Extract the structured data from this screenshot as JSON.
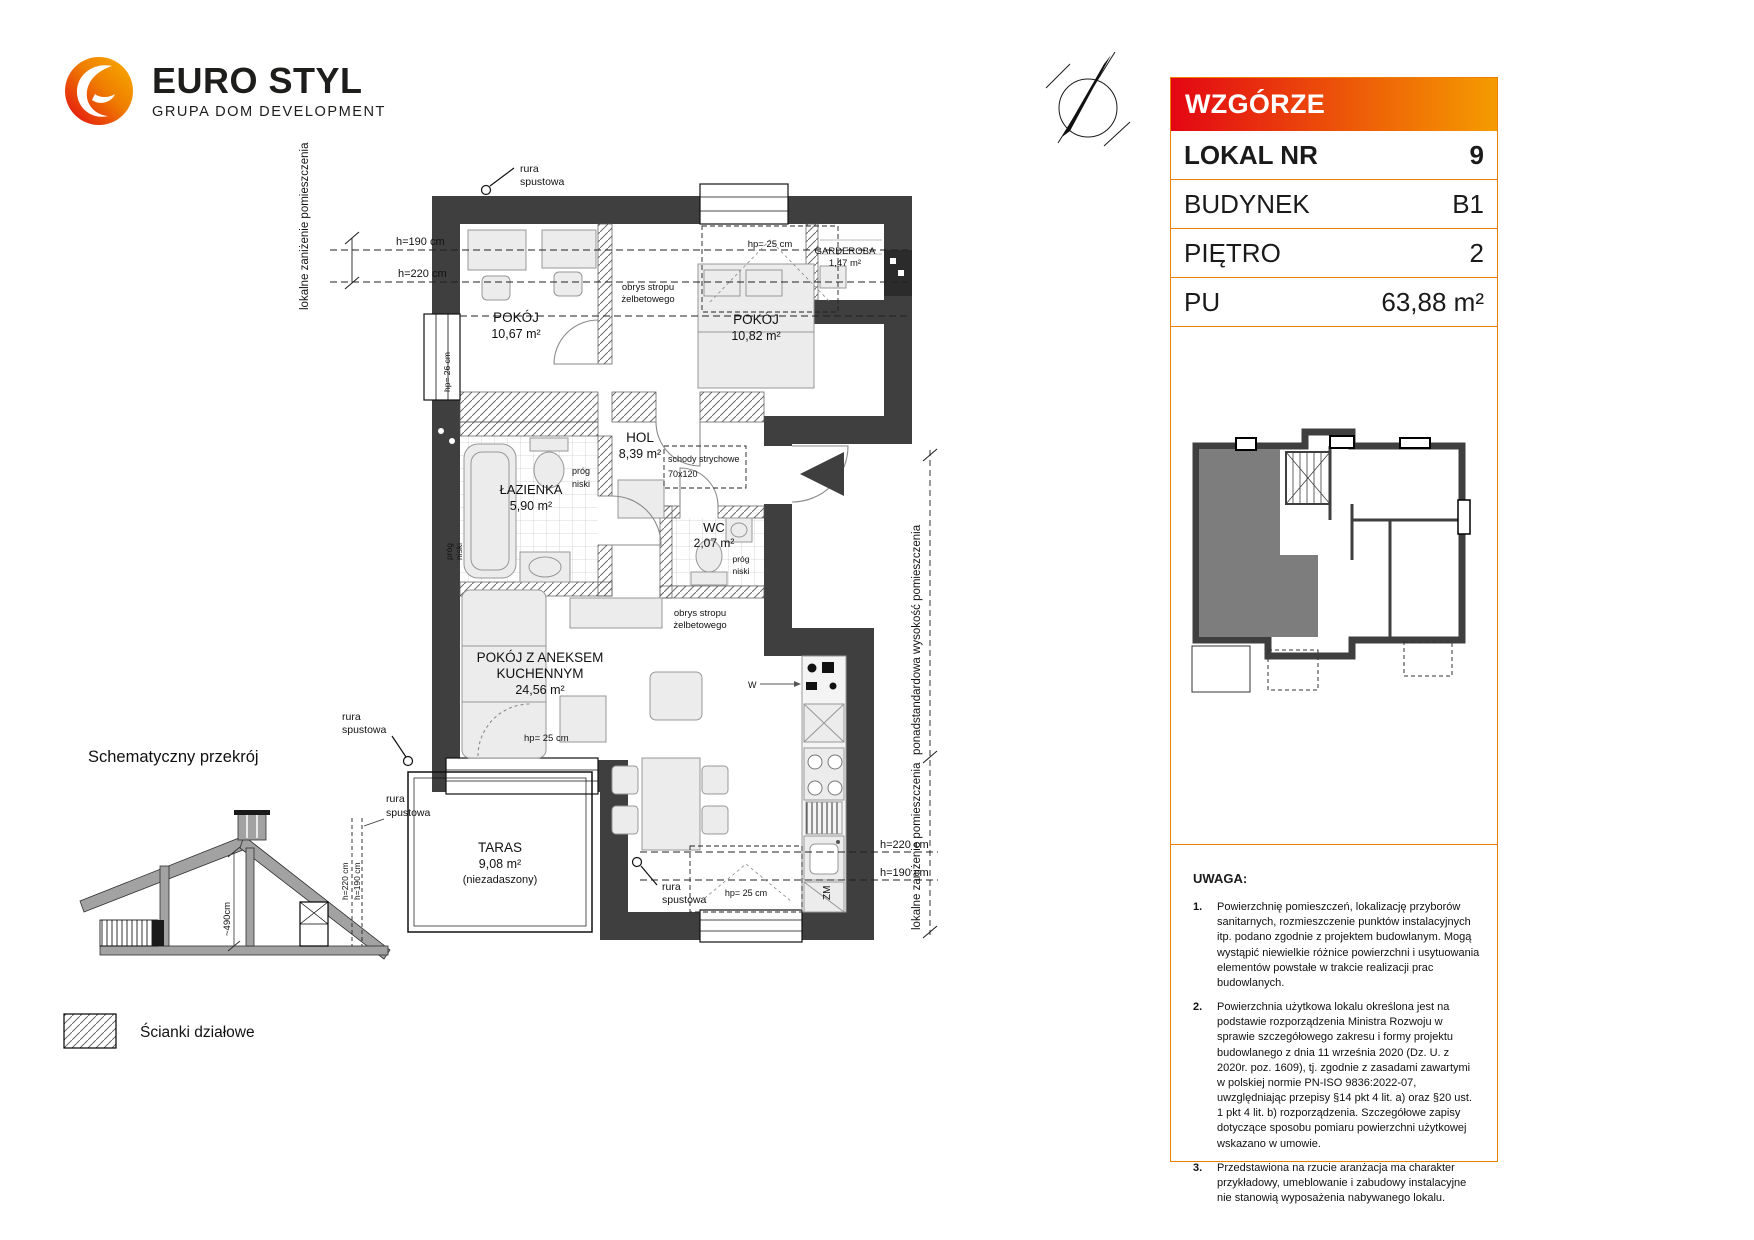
{
  "logo": {
    "brand": "EURO STYL",
    "tagline": "GRUPA DOM DEVELOPMENT"
  },
  "colors": {
    "accent_orange": "#ee7f00",
    "header_gradient_left": "#e30613",
    "header_gradient_right": "#f59c00",
    "wall": "#3f3f3f",
    "unit_highlight": "#7d7d7d"
  },
  "panel": {
    "title": "WZGÓRZE MARKOWCA",
    "rows": [
      {
        "label": "LOKAL NR",
        "value": "9"
      },
      {
        "label": "BUDYNEK",
        "value": "B1"
      },
      {
        "label": "PIĘTRO",
        "value": "2"
      },
      {
        "label": "PU",
        "value": "63,88 m²"
      }
    ],
    "notes_title": "UWAGA:",
    "notes": [
      {
        "num": "1.",
        "text": "Powierzchnię pomieszczeń, lokalizację przyborów sanitarnych, rozmieszczenie punktów instalacyjnych itp. podano zgodnie z projektem budowlanym. Mogą wystąpić niewielkie różnice powierzchni i usytuowania elementów powstałe w trakcie realizacji prac budowlanych."
      },
      {
        "num": "2.",
        "text": "Powierzchnia użytkowa lokalu określona jest na podstawie rozporządzenia Ministra Rozwoju w sprawie szczegółowego zakresu i formy projektu budowlanego z dnia 11 września 2020 (Dz. U. z 2020r. poz. 1609), tj. zgodnie z zasadami zawartymi w polskiej normie PN-ISO 9836:2022-07, uwzględniając przepisy §14 pkt 4 lit. a) oraz §20 ust. 1 pkt 4 lit. b) rozporządzenia. Szczegółowe zapisy dotyczące sposobu pomiaru powierzchni użytkowej wskazano w umowie."
      },
      {
        "num": "3.",
        "text": "Przedstawiona na rzucie aranżacja ma charakter przykładowy, umeblowanie i zabudowy instalacyjne nie stanowią wyposażenia nabywanego lokalu."
      }
    ]
  },
  "floorplan": {
    "rooms": {
      "pokoj1_name": "POKÓJ",
      "pokoj1_area": "10,67 m²",
      "pokoj2_name": "POKÓJ",
      "pokoj2_area": "10,82 m²",
      "garderoba_name": "GARDEROBA",
      "garderoba_area": "1,47 m²",
      "hol_name": "HOL",
      "hol_area": "8,39 m²",
      "lazienka_name": "ŁAZIENKA",
      "lazienka_area": "5,90 m²",
      "wc_name": "WC",
      "wc_area": "2,07 m²",
      "salon_name1": "POKÓJ Z ANEKSEM",
      "salon_name2": "KUCHENNYM",
      "salon_area": "24,56 m²",
      "taras_name": "TARAS",
      "taras_area": "9,08 m²",
      "taras_note": "(niezadaszony)"
    },
    "annotations": {
      "rura_line1": "rura",
      "rura_line2": "spustowa",
      "h190": "h=190 cm",
      "h220": "h=220 cm",
      "hp25": "hp= 25 cm",
      "hp26": "hp= 26 cm",
      "obrys_line1": "obrys stropu",
      "obrys_line2": "żelbetowego",
      "schody_line1": "schody strychowe",
      "schody_line2": "70x120",
      "prog_line1": "próg",
      "prog_line2": "niski",
      "zm": "ZM",
      "w": "W",
      "lokalne": "lokalne zaniżenie pomieszczenia",
      "ponad": "ponadstandardowa wysokość pomieszczenia"
    }
  },
  "section": {
    "title": "Schematyczny przekrój",
    "dim": "~490cm",
    "h220": "h=220 cm",
    "h190": "h=190 cm",
    "rura_line1": "rura",
    "rura_line2": "spustowa"
  },
  "legend": {
    "label": "Ścianki działowe"
  }
}
